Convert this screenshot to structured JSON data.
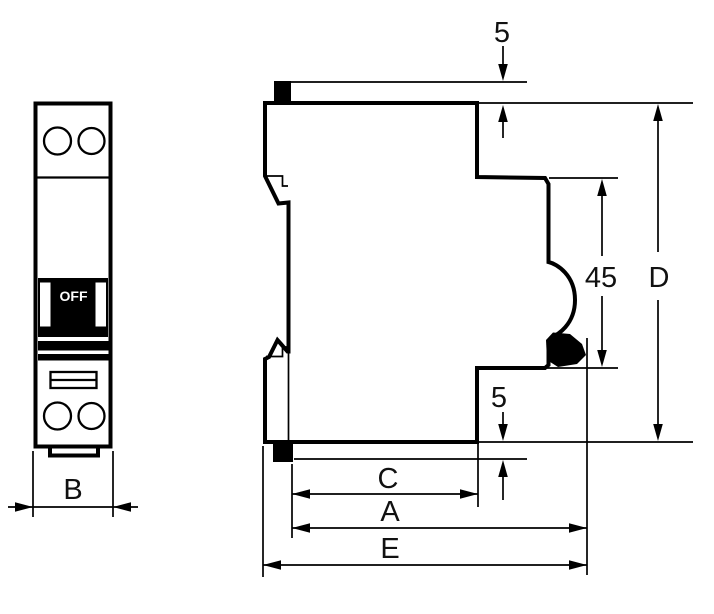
{
  "drawing": {
    "front_view": {
      "toggle_label": "OFF",
      "width_dim_label": "B"
    },
    "side_view": {
      "top_clearance_label": "5",
      "recess_height_label": "45",
      "overall_height_label": "D",
      "bottom_clearance_label": "5",
      "depth_c_label": "C",
      "depth_a_label": "A",
      "depth_e_label": "E"
    }
  }
}
